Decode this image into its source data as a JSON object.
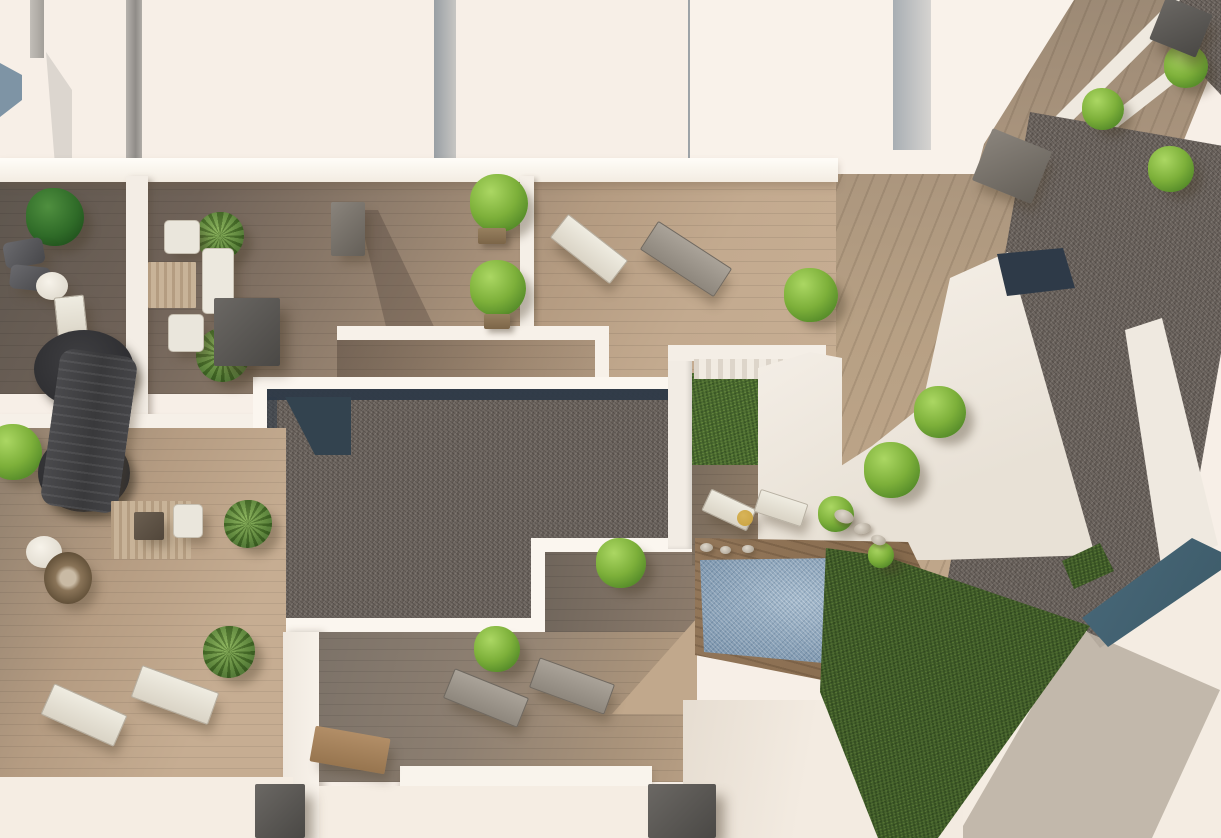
{
  "meta": {
    "title": "Aerial top-down 3D render of rooftop terraces",
    "description": "Photorealistic bird's-eye architectural rendering showing rooftop terraces with wooden decking, gravel flat roofs, a swimming pool, lawn areas, trees, plants and outdoor furniture. No text or UI elements are visible.",
    "view": "top-down"
  },
  "palette": {
    "sky_white": "#f7efe7",
    "roof_white": "#f9f2ea",
    "wood_light": "#c3aa8f",
    "wood_mid": "#a08a74",
    "wood_dark": "#5e564e",
    "gravel": "#6e6660",
    "navy": "#2e3a48",
    "teal": "#3c5a68",
    "pool": "#8aa5bd",
    "pool_deck": "#8b6f51",
    "grass": "#44602c",
    "shadow_beige": "#bdb3a5",
    "tree_green": "#7db03a",
    "furn_white": "#eae6dc",
    "furn_dark": "#4a4845",
    "bench_wood": "#b28e67",
    "table_yellow": "#c8a13e"
  },
  "scene": {
    "trees": [
      {
        "x": 26,
        "y": 188,
        "d": 58,
        "variant": "dark",
        "name": "bush-terrace-upper-left"
      },
      {
        "x": 470,
        "y": 174,
        "d": 58,
        "variant": "light",
        "name": "potted-tree-center-1"
      },
      {
        "x": 470,
        "y": 260,
        "d": 56,
        "variant": "light",
        "name": "potted-tree-center-2"
      },
      {
        "x": 784,
        "y": 268,
        "d": 54,
        "variant": "light",
        "name": "tree-tilted-terrace-top"
      },
      {
        "x": 914,
        "y": 386,
        "d": 52,
        "variant": "light",
        "name": "tree-tilted-terrace-mid"
      },
      {
        "x": 864,
        "y": 442,
        "d": 56,
        "variant": "light",
        "name": "tree-tilted-terrace-low"
      },
      {
        "x": 596,
        "y": 538,
        "d": 50,
        "variant": "light",
        "name": "bush-below-gravel-1"
      },
      {
        "x": 474,
        "y": 626,
        "d": 46,
        "variant": "light",
        "name": "bush-below-gravel-2"
      },
      {
        "x": -14,
        "y": 424,
        "d": 56,
        "variant": "light",
        "name": "bush-left-edge"
      },
      {
        "x": 818,
        "y": 496,
        "d": 36,
        "variant": "light",
        "name": "bush-courtyard"
      },
      {
        "x": 1082,
        "y": 88,
        "d": 42,
        "variant": "light",
        "name": "bush-right-wing-1"
      },
      {
        "x": 1148,
        "y": 146,
        "d": 46,
        "variant": "light",
        "name": "bush-right-wing-2"
      },
      {
        "x": 1164,
        "y": 44,
        "d": 44,
        "variant": "light",
        "name": "bush-top-right-corner"
      },
      {
        "x": 868,
        "y": 542,
        "d": 26,
        "variant": "light",
        "name": "tuft-pool-corner"
      },
      {
        "x": 196,
        "y": 212,
        "d": 48,
        "variant": "palm",
        "name": "palm-terrace-1"
      },
      {
        "x": 196,
        "y": 328,
        "d": 54,
        "variant": "palm",
        "name": "palm-terrace-2"
      },
      {
        "x": 203,
        "y": 626,
        "d": 52,
        "variant": "palm",
        "name": "palm-lower-left"
      },
      {
        "x": 224,
        "y": 500,
        "d": 48,
        "variant": "palm",
        "name": "palm-lower-left-2"
      }
    ],
    "furniture": [
      {
        "x": 4,
        "y": 240,
        "w": 40,
        "h": 26,
        "rot": -10,
        "kind": "armchair-dark"
      },
      {
        "x": 10,
        "y": 266,
        "w": 40,
        "h": 24,
        "rot": 6,
        "kind": "armchair-dark"
      },
      {
        "x": 36,
        "y": 272,
        "w": 32,
        "h": 28,
        "rot": 0,
        "kind": "table-round"
      },
      {
        "x": 56,
        "y": 296,
        "w": 28,
        "h": 42,
        "rot": -6,
        "kind": "lounger-white"
      },
      {
        "x": 34,
        "y": 330,
        "w": 100,
        "h": 78,
        "rot": 0,
        "kind": "dark-disc"
      },
      {
        "x": 38,
        "y": 434,
        "w": 92,
        "h": 78,
        "rot": 0,
        "kind": "dark-disc"
      },
      {
        "x": 50,
        "y": 352,
        "w": 78,
        "h": 158,
        "rot": 8,
        "kind": "dark-structure"
      },
      {
        "x": 164,
        "y": 220,
        "w": 34,
        "h": 32,
        "rot": 0,
        "kind": "armchair-white"
      },
      {
        "x": 148,
        "y": 262,
        "w": 48,
        "h": 46,
        "rot": 0,
        "kind": "rug"
      },
      {
        "x": 202,
        "y": 248,
        "w": 30,
        "h": 64,
        "rot": 0,
        "kind": "sofa-white"
      },
      {
        "x": 168,
        "y": 314,
        "w": 34,
        "h": 36,
        "rot": 0,
        "kind": "armchair-white"
      },
      {
        "x": 214,
        "y": 298,
        "w": 66,
        "h": 68,
        "rot": 0,
        "kind": "box-dark"
      },
      {
        "x": 331,
        "y": 202,
        "w": 34,
        "h": 54,
        "rot": 0,
        "kind": "chimney"
      },
      {
        "x": 551,
        "y": 234,
        "w": 74,
        "h": 28,
        "rot": 38,
        "kind": "lounger-white"
      },
      {
        "x": 642,
        "y": 242,
        "w": 86,
        "h": 32,
        "rot": 33,
        "kind": "lounger-gray"
      },
      {
        "x": 478,
        "y": 228,
        "w": 28,
        "h": 16,
        "rot": 0,
        "kind": "pot"
      },
      {
        "x": 484,
        "y": 314,
        "w": 26,
        "h": 15,
        "rot": 0,
        "kind": "pot"
      },
      {
        "x": 111,
        "y": 501,
        "w": 80,
        "h": 58,
        "rot": 0,
        "kind": "rug"
      },
      {
        "x": 134,
        "y": 512,
        "w": 30,
        "h": 28,
        "rot": 0,
        "kind": "table-dark"
      },
      {
        "x": 173,
        "y": 504,
        "w": 28,
        "h": 32,
        "rot": 0,
        "kind": "armchair-white"
      },
      {
        "x": 26,
        "y": 536,
        "w": 36,
        "h": 32,
        "rot": 0,
        "kind": "table-round"
      },
      {
        "x": 44,
        "y": 552,
        "w": 48,
        "h": 52,
        "rot": 0,
        "kind": "wicker"
      },
      {
        "x": 44,
        "y": 698,
        "w": 78,
        "h": 32,
        "rot": 24,
        "kind": "lounger-white"
      },
      {
        "x": 134,
        "y": 678,
        "w": 80,
        "h": 32,
        "rot": 20,
        "kind": "lounger-white"
      },
      {
        "x": 446,
        "y": 682,
        "w": 78,
        "h": 30,
        "rot": 22,
        "kind": "lounger-gray"
      },
      {
        "x": 532,
        "y": 670,
        "w": 78,
        "h": 30,
        "rot": 20,
        "kind": "lounger-gray"
      },
      {
        "x": 704,
        "y": 498,
        "w": 48,
        "h": 22,
        "rot": 25,
        "kind": "lounger-white"
      },
      {
        "x": 756,
        "y": 496,
        "w": 48,
        "h": 22,
        "rot": 18,
        "kind": "lounger-white"
      },
      {
        "x": 737,
        "y": 510,
        "w": 16,
        "h": 16,
        "rot": 0,
        "kind": "table-yellow"
      },
      {
        "x": 980,
        "y": 138,
        "w": 64,
        "h": 56,
        "rot": 22,
        "kind": "chimney"
      },
      {
        "x": 1156,
        "y": 4,
        "w": 50,
        "h": 46,
        "rot": 22,
        "kind": "box-dark"
      },
      {
        "x": 312,
        "y": 732,
        "w": 76,
        "h": 36,
        "rot": 10,
        "kind": "bench"
      },
      {
        "x": 648,
        "y": 784,
        "w": 68,
        "h": 54,
        "rot": 0,
        "kind": "box-dark"
      },
      {
        "x": 255,
        "y": 784,
        "w": 50,
        "h": 54,
        "rot": 0,
        "kind": "box-dark"
      },
      {
        "x": 834,
        "y": 510,
        "w": 20,
        "h": 13,
        "rot": 20,
        "kind": "stone"
      },
      {
        "x": 854,
        "y": 523,
        "w": 17,
        "h": 11,
        "rot": -10,
        "kind": "stone"
      },
      {
        "x": 871,
        "y": 535,
        "w": 15,
        "h": 10,
        "rot": 15,
        "kind": "stone"
      },
      {
        "x": 700,
        "y": 543,
        "w": 13,
        "h": 9,
        "rot": 0,
        "kind": "stone"
      },
      {
        "x": 720,
        "y": 546,
        "w": 11,
        "h": 8,
        "rot": 0,
        "kind": "stone"
      },
      {
        "x": 742,
        "y": 545,
        "w": 12,
        "h": 8,
        "rot": 0,
        "kind": "stone"
      }
    ]
  }
}
